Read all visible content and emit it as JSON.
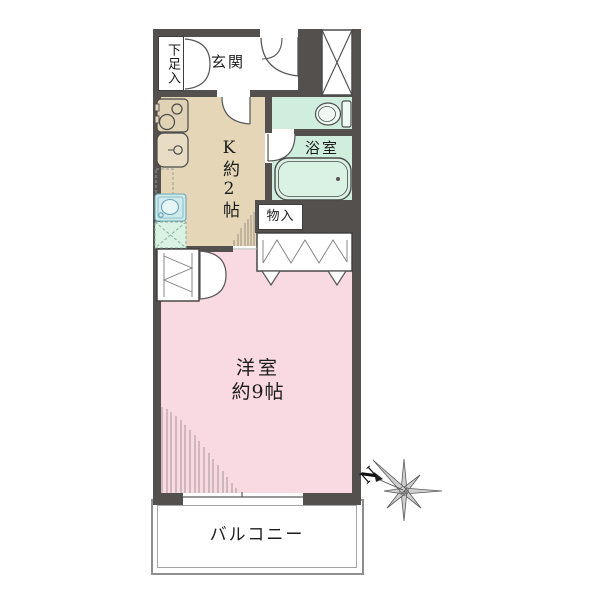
{
  "labels": {
    "shoe_storage": "下足入",
    "entrance": "玄関",
    "kitchen": "K約2帖",
    "bathroom": "浴室",
    "storage": "物入",
    "western_room_name": "洋室",
    "western_room_size": "約9帖",
    "balcony": "バルコニー",
    "compass_north": "N"
  },
  "theme": {
    "wall": "#54504e",
    "kitchen_floor": "#e5d6b8",
    "wet_area": "#cfeedd",
    "room_floor": "#f9d9e2",
    "washer_pan": "#cfeaea",
    "fridge_space": "#d9f2e4",
    "line": "#555555",
    "text": "#1c1c1c"
  }
}
